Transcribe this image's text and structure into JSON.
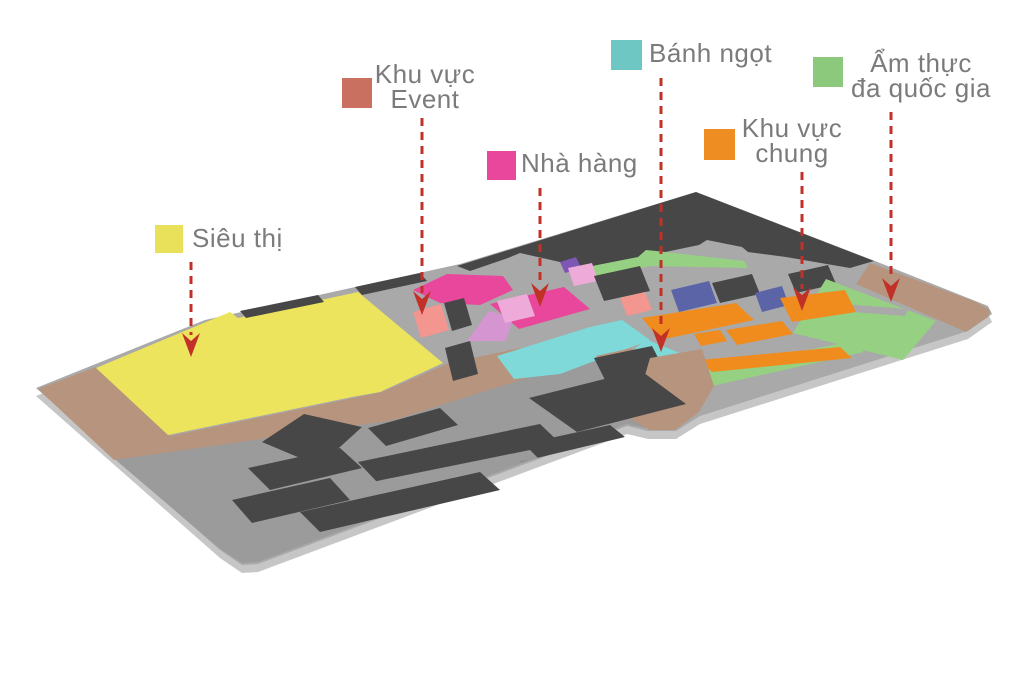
{
  "legend": {
    "text_color": "#7b7b7b",
    "items": [
      {
        "id": "sieu-thi",
        "label": "Siêu thị",
        "color": "#e9e159"
      },
      {
        "id": "khu-vuc-event",
        "label": "Khu vực\nEvent",
        "color": "#c97060"
      },
      {
        "id": "nha-hang",
        "label": "Nhà hàng",
        "color": "#e8479b"
      },
      {
        "id": "banh-ngot",
        "label": "Bánh ngọt",
        "color": "#6fc7c3"
      },
      {
        "id": "khu-vuc-chung",
        "label": "Khu vực\nchung",
        "color": "#ee8d22"
      },
      {
        "id": "am-thuc-da-quoc-gia",
        "label": "Ẩm thực\nđa quốc gia",
        "color": "#8cc97c"
      }
    ]
  },
  "map": {
    "colors": {
      "floor": "#a9a9a9",
      "floor_side": "#c6c6c6",
      "parking": "#9b9b9b",
      "dark": "#474747",
      "tan": "#b7947e",
      "yellow": "#ece45c",
      "pink": "#e8479b",
      "pink_light": "#eeaad8",
      "orchid": "#d495d0",
      "salmon": "#f2968f",
      "purple": "#7e57b4",
      "blue": "#5c64a8",
      "teal": "#7fd9d9",
      "green": "#96d083",
      "orange": "#f08c1e",
      "arrow": "#c23128"
    }
  }
}
